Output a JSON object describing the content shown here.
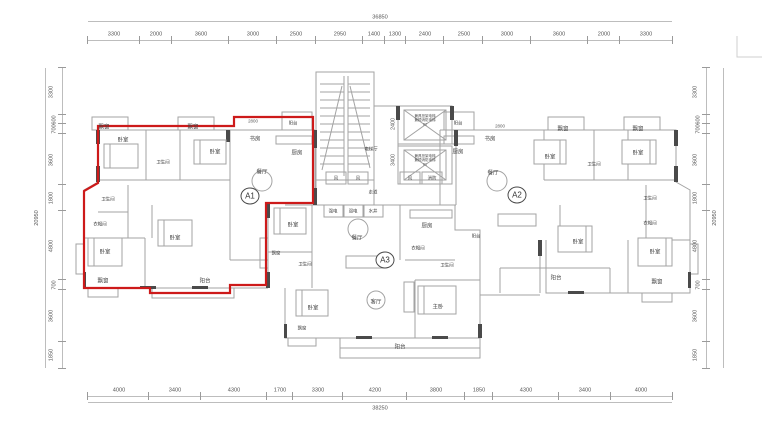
{
  "colors": {
    "unit_outline_red": "#cd1a1a",
    "line_gray": "#a3a3a3",
    "wall_dark": "#4a4a4a",
    "dim_text": "#555555"
  },
  "dimensions": {
    "top": {
      "total": "36850",
      "segments": [
        3300,
        2000,
        3600,
        3000,
        2500,
        2950,
        1400,
        1300,
        2400,
        2500,
        3000,
        3600,
        2000,
        3300
      ]
    },
    "bottom": {
      "total": "38250",
      "segments": [
        4000,
        3400,
        4300,
        1700,
        3300,
        4200,
        3800,
        1850,
        4300,
        3400,
        4000
      ]
    },
    "left": {
      "total": "20950",
      "segments": [
        3300,
        600,
        700,
        3600,
        1800,
        4800,
        700,
        3600,
        1850
      ]
    },
    "right": {
      "total": "20950",
      "segments": [
        3300,
        600,
        700,
        3600,
        1800,
        4800,
        700,
        3600,
        1850
      ]
    }
  },
  "units": {
    "a1": "A1",
    "a2": "A2",
    "a3": "A3"
  },
  "rooms": {
    "bedroom": "卧室",
    "master_bedroom": "主卧",
    "bay_window": "飘窗",
    "bathroom": "卫生间",
    "cloakroom": "衣帽间",
    "study": "书房",
    "kitchen": "厨房",
    "dining": "餐厅",
    "living": "客厅",
    "balcony": "阳台",
    "corridor": "走道",
    "elevator_hall": "电梯厅",
    "vent": "风",
    "fire": "消防",
    "strong_elec": "强电",
    "weak_elec": "弱电",
    "water_shaft": "水井"
  },
  "elevators": {
    "note_line1": "兼具担架电梯",
    "note_line2": "兼顾消防电梯",
    "car02": "02",
    "car01": "01"
  },
  "inner_dims": {
    "study_width": "2800",
    "hall_upper": "2400",
    "hall_lower": "3400"
  }
}
